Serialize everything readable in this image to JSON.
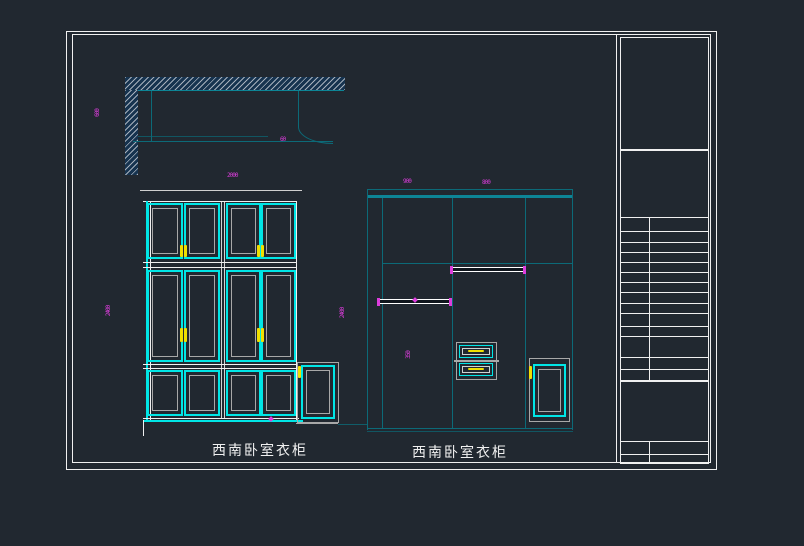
{
  "app": {
    "type": "cad-viewport",
    "background": "#212830"
  },
  "labels": {
    "left_view": "西南卧室衣柜",
    "right_view": "西南卧室衣柜"
  },
  "dimensions": {
    "plan_height_left": "600",
    "plan_note": "60",
    "left_width_top": "2000",
    "left_height_left": "2400",
    "left_height_right": "2400",
    "right_width_left": "900",
    "right_width_right": "800",
    "right_drawer_height": "350"
  },
  "colors": {
    "background": "#212830",
    "border_white": "#f0f0f0",
    "door_frame_cyan": "#00e6e6",
    "construction_teal": "#0c6a78",
    "panel_frame_gray": "#a8a8a8",
    "handle_yellow": "#f0e000",
    "dimension_magenta": "#dd3ddd",
    "hatch_fill_blue": "#16334f"
  }
}
